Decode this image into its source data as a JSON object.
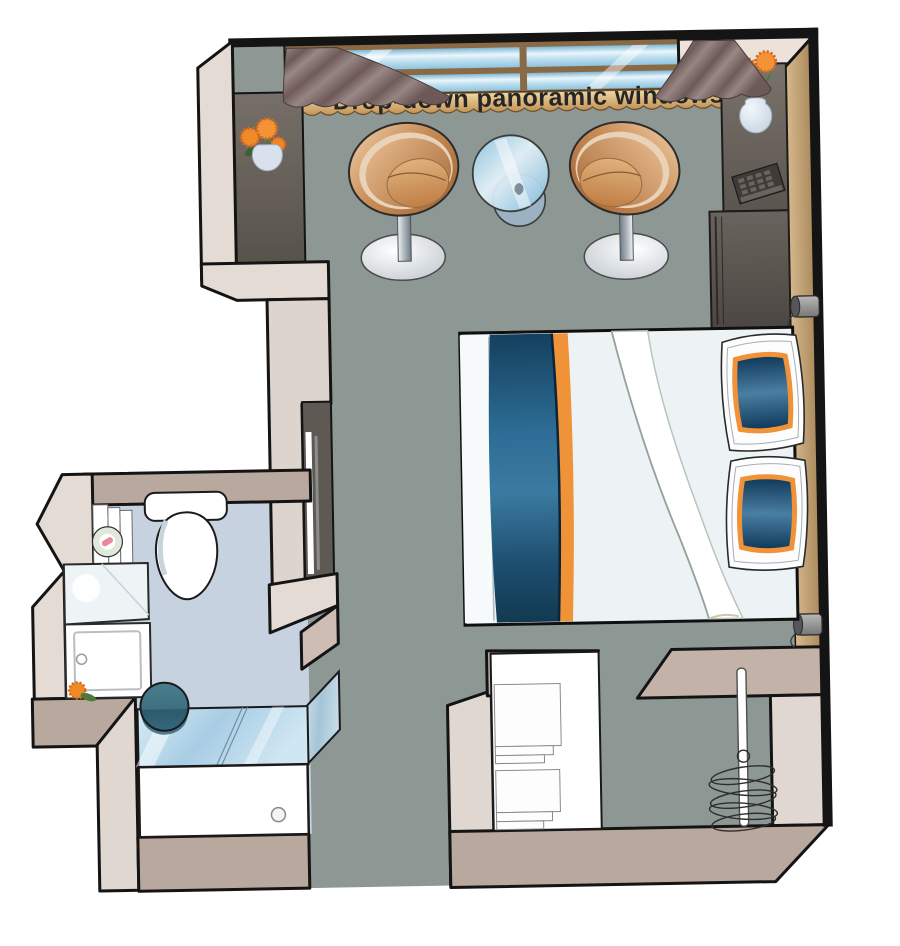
{
  "window": {
    "label": "Drop-down panoramic windows"
  },
  "plan": {
    "type": "cruise-cabin-floor-plan",
    "rooms": [
      "main-cabin",
      "bathroom",
      "entry-corridor",
      "closet",
      "wardrobe"
    ],
    "furniture": [
      "tub-chair-left",
      "tub-chair-right",
      "glass-side-table",
      "double-bed",
      "pillow-top",
      "pillow-bottom",
      "desk-unit",
      "tv-remote",
      "minibar-cabinet",
      "flower-vase-wall",
      "flower-vase-desk",
      "flower-vanity",
      "wall-lamp-upper",
      "wall-lamp-lower",
      "toilet",
      "toilet-roll-holder",
      "vanity-counter",
      "vanity-cabinet",
      "teal-stool",
      "shower-glass",
      "shower-tray",
      "shelf-stack-1",
      "shelf-stack-2",
      "hanging-rail",
      "hangers",
      "curtain-left",
      "curtain-right",
      "wall-mirror"
    ]
  },
  "colors": {
    "floor": "#8d9793",
    "bath_floor": "#c6d2e0",
    "wall_light": "#e3dbd4",
    "wall_dark": "#b9a89d",
    "outline": "#141414",
    "wood": "#c3a379",
    "window_glass": "#bcdcee",
    "copper_chair": "#c98d58",
    "curtain": "#8d7976",
    "accent_orange": "#ef9238",
    "navy": "#16425f",
    "desk_gray": "#645e58",
    "teal": "#3e6f81",
    "flower_orange": "#f08a28"
  }
}
